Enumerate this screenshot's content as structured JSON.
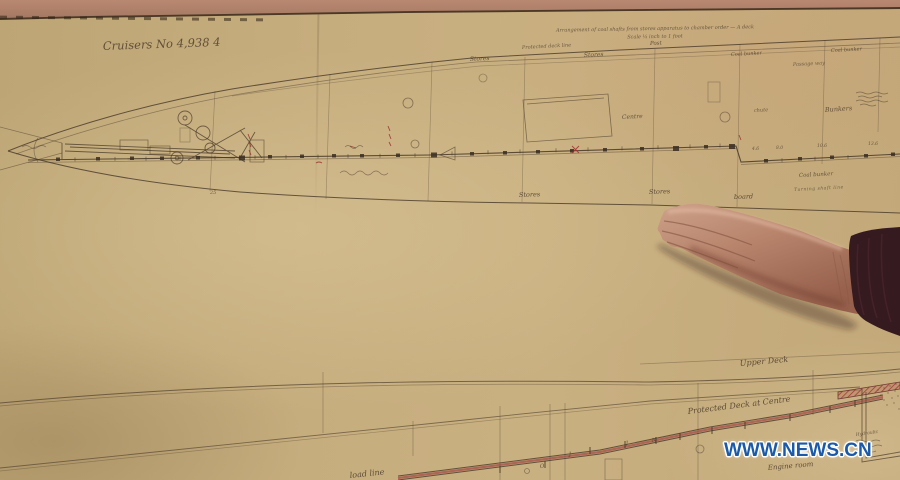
{
  "watermark": {
    "text": "WWW.NEWS.CN"
  },
  "blueprint": {
    "sheet_title": "Cruisers No 4,938 4",
    "header_note_line1": "Arrangement of coal shafts from stores apparatus to chamber order — A deck",
    "header_note_line2": "Scale ¼ inch to 1 foot",
    "plan_labels": {
      "protected_deck_line": "Protected deck line",
      "stores_top_left": "Stores",
      "stores_top_mid": "Stores",
      "post": "Post",
      "coal_bunker_top_mid": "Coal bunker",
      "passage_way": "Passage way",
      "coal_bunker_top_right": "Coal bunker",
      "centre": "Centre",
      "chute": "chute",
      "bunkers": "Bunkers",
      "stores_bottom_left": "Stores",
      "stores_bottom_right": "Stores",
      "board": "board",
      "coal_bunker_bottom": "Coal bunker",
      "turning_line": "Turning shaft line",
      "frame_number": "25"
    },
    "measurements": [
      "4.6",
      "8.0",
      "10.6",
      "13.6"
    ],
    "profile_labels": {
      "upper_deck": "Upper Deck",
      "protected_deck_centre": "Protected Deck at Centre",
      "load_line": "load line",
      "engine_room": "Engine room",
      "hydraulic": "Hydraulic",
      "frame_letters": [
        "O",
        "J",
        "J",
        "N"
      ]
    }
  }
}
